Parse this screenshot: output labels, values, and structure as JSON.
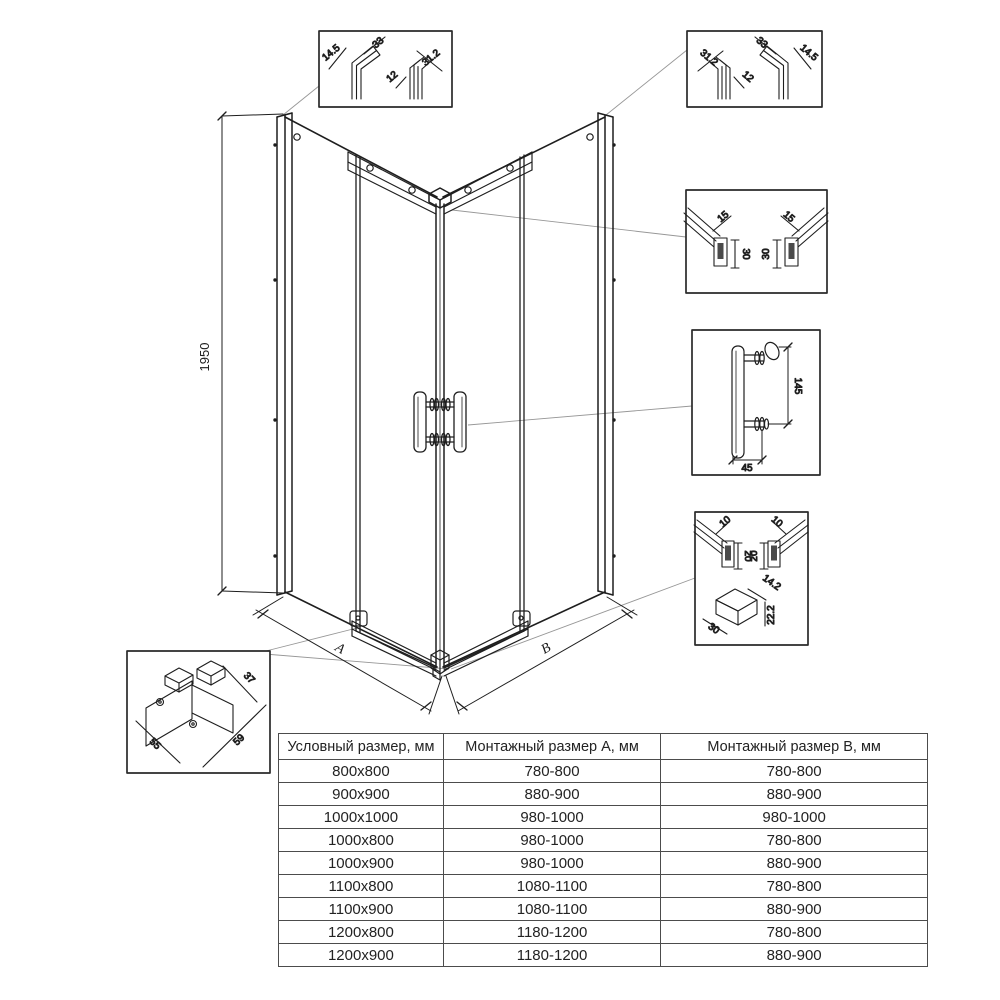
{
  "diagram": {
    "height_dim": "1950",
    "dim_a": "A",
    "dim_b": "B"
  },
  "details": {
    "wall_profile_left": {
      "dims": [
        "14.5",
        "33",
        "12",
        "31.2"
      ]
    },
    "wall_profile_right": {
      "dims": [
        "31.2",
        "12",
        "33",
        "14.5"
      ]
    },
    "top_rail": {
      "dims": [
        "15",
        "30",
        "15",
        "30"
      ]
    },
    "handle": {
      "dims": [
        "145",
        "45"
      ]
    },
    "bottom_rail": {
      "dims": [
        "10",
        "20",
        "10",
        "20",
        "14.2",
        "22.2",
        "30"
      ]
    },
    "roller_bracket": {
      "dims": [
        "37",
        "55",
        "59"
      ]
    }
  },
  "table": {
    "headers": [
      "Условный размер, мм",
      "Монтажный размер А, мм",
      "Монтажный размер В, мм"
    ],
    "rows": [
      [
        "800x800",
        "780-800",
        "780-800"
      ],
      [
        "900x900",
        "880-900",
        "880-900"
      ],
      [
        "1000x1000",
        "980-1000",
        "980-1000"
      ],
      [
        "1000x800",
        "980-1000",
        "780-800"
      ],
      [
        "1000x900",
        "980-1000",
        "880-900"
      ],
      [
        "1100x800",
        "1080-1100",
        "780-800"
      ],
      [
        "1100x900",
        "1080-1100",
        "880-900"
      ],
      [
        "1200x800",
        "1180-1200",
        "780-800"
      ],
      [
        "1200x900",
        "1180-1200",
        "880-900"
      ]
    ]
  }
}
